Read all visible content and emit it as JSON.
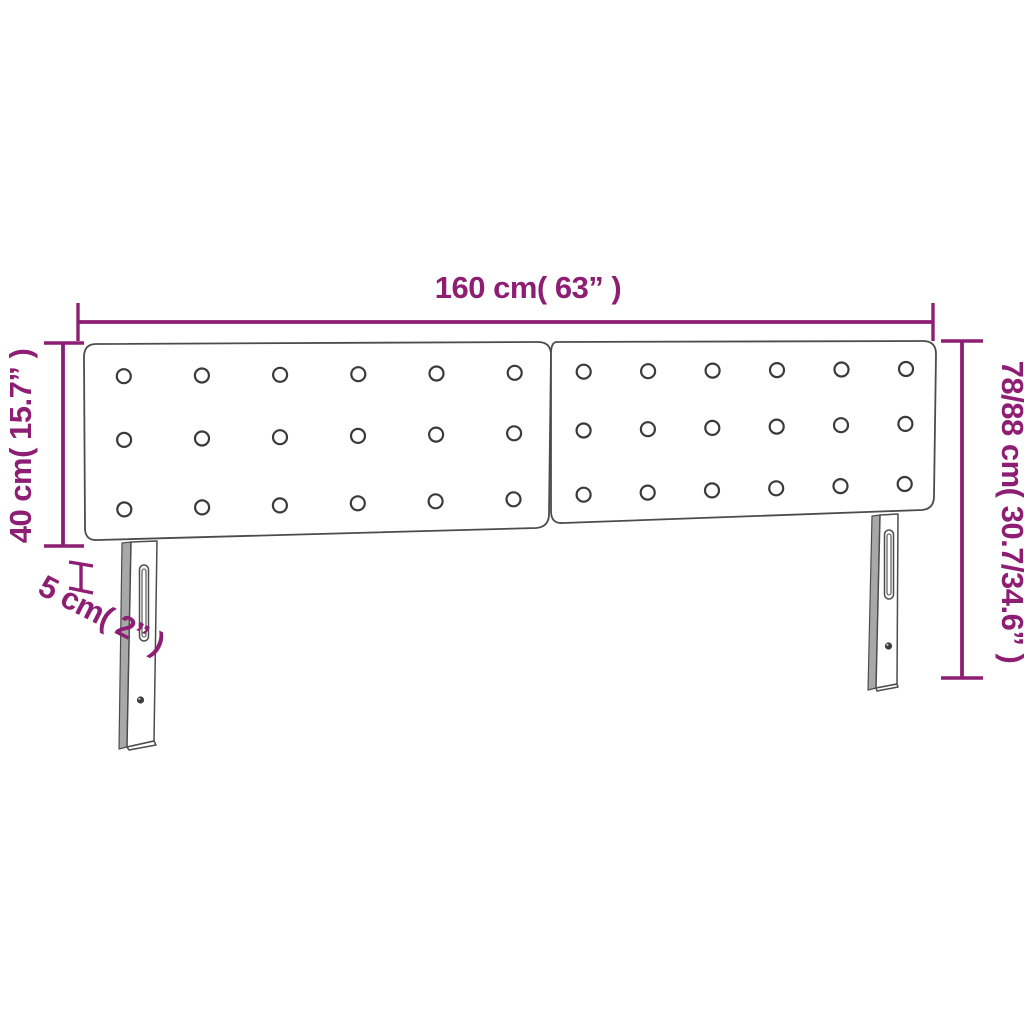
{
  "diagram": {
    "dimensions": {
      "width_label": "160 cm( 63” )",
      "height_left_label": "40 cm( 15.7” )",
      "height_right_label": "78/88 cm( 30.7/34.6” )",
      "depth_label": "5 cm( 2” )"
    },
    "colors": {
      "dimension_accent": "#8d1e73",
      "product_outline": "#4c4c4c",
      "leg_side_fill": "#a8a8a8",
      "background": "#ffffff"
    },
    "product": {
      "panels": 2,
      "button_rows": 3,
      "button_cols": 6,
      "legs": 2
    }
  }
}
